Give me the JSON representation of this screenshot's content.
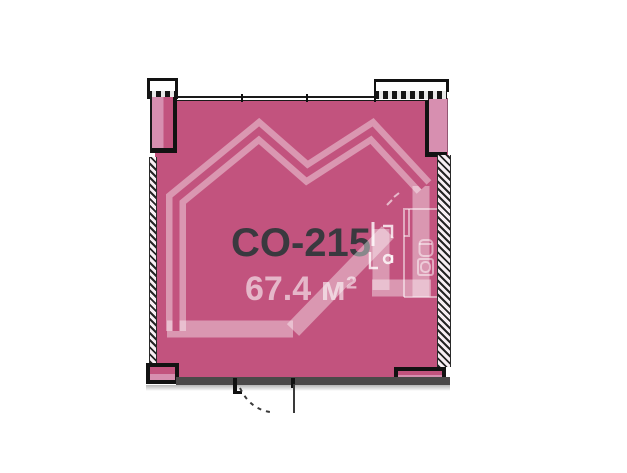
{
  "plan": {
    "unit_id": "CO-215",
    "area": "67.4 м²"
  },
  "colors": {
    "unit_fill": "#c2537e",
    "unit_fill_light": "#d78fb0",
    "watermark": "rgba(255,255,255,0.40)",
    "area_text": "rgba(255,255,255,0.58)",
    "unit_text": "#3a393f",
    "wall_dark": "#4b4949",
    "outline": "#121212",
    "background": "#ffffff"
  }
}
